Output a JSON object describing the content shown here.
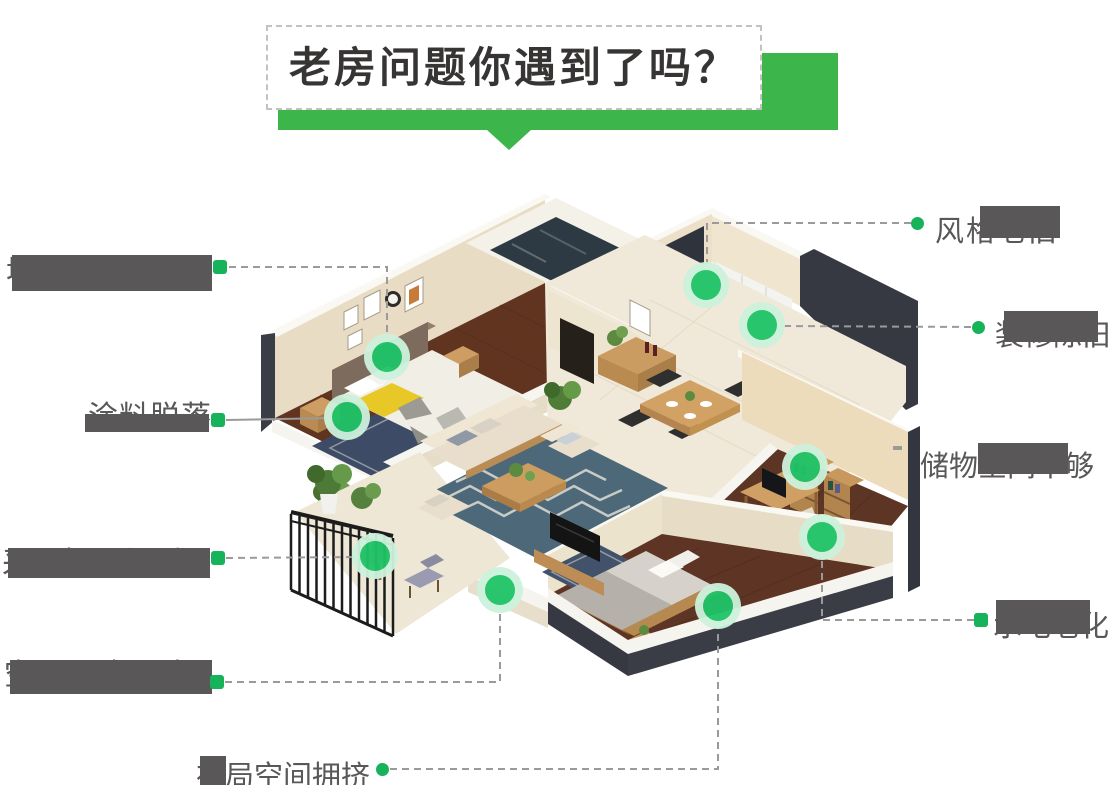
{
  "title": {
    "text": "老房问题你遇到了吗？"
  },
  "callouts": [
    {
      "id": "wall-mold",
      "text": "墙面发霉",
      "redacted": true,
      "connector": "dashed"
    },
    {
      "id": "paint-peeling",
      "text": "涂料脱落",
      "redacted": true,
      "connector": "solid"
    },
    {
      "id": "poor-lighting",
      "text": "采光昏暗",
      "redacted": true,
      "connector": "dashed"
    },
    {
      "id": "space-congested",
      "text": "空间拥堵",
      "redacted": true,
      "connector": "dashed"
    },
    {
      "id": "layout-crowded",
      "text": "布局空间拥挤",
      "redacted": true,
      "connector": "dashed"
    },
    {
      "id": "style-outdated",
      "text": "风格老旧",
      "redacted": true,
      "connector": "dashed"
    },
    {
      "id": "decor-outdated",
      "text": "装修陈旧",
      "redacted": true,
      "connector": "dashed"
    },
    {
      "id": "storage-insufficient",
      "text": "储物空间不够",
      "redacted": true,
      "connector": "none"
    },
    {
      "id": "plumbing-aging",
      "text": "水电老化",
      "redacted": true,
      "connector": "dashed"
    }
  ],
  "colors": {
    "banner-green": "#3cb54a",
    "marker-green": "#17b35a",
    "dot-green": "#1fc468",
    "dot-halo": "#cdf2dd",
    "ink": "#595757",
    "line-gray": "#9a9a9a",
    "title-ink": "#373434"
  }
}
